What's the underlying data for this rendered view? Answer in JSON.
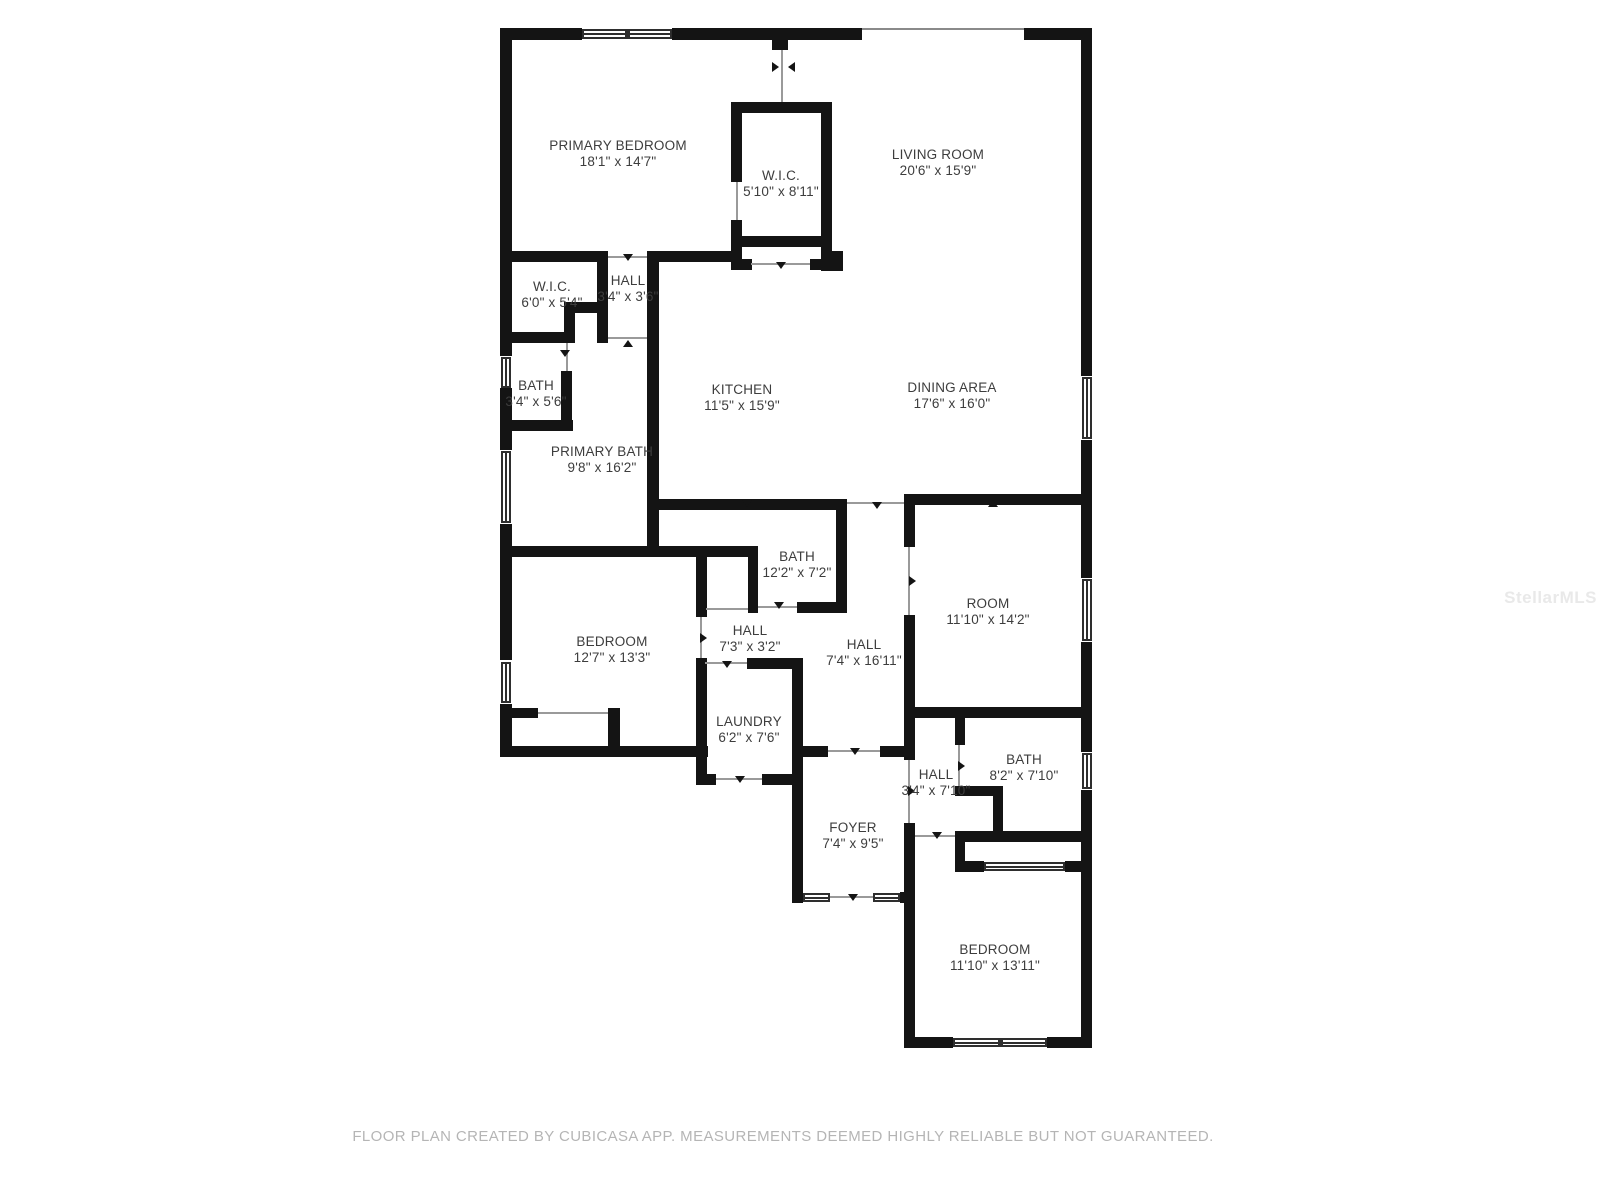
{
  "footer": "FLOOR PLAN CREATED BY CUBICASA APP. MEASUREMENTS DEEMED HIGHLY RELIABLE BUT NOT GUARANTEED.",
  "watermark": "StellarMLS",
  "colors": {
    "wall": "#141414",
    "label": "#3d3d3d",
    "footer": "#b5b5b5",
    "watermark": "#e9e9e9"
  },
  "rooms": [
    {
      "id": "primary-bedroom",
      "name": "PRIMARY BEDROOM",
      "dims": "18'1\" x 14'7\""
    },
    {
      "id": "wic-primary",
      "name": "W.I.C.",
      "dims": "5'10\" x 8'11\""
    },
    {
      "id": "living-room",
      "name": "LIVING ROOM",
      "dims": "20'6\" x 15'9\""
    },
    {
      "id": "wic-small",
      "name": "W.I.C.",
      "dims": "6'0\" x 5'4\""
    },
    {
      "id": "hall-small",
      "name": "HALL",
      "dims": "3'4\" x 3'6\""
    },
    {
      "id": "bath-small",
      "name": "BATH",
      "dims": "3'4\" x 5'6\""
    },
    {
      "id": "kitchen",
      "name": "KITCHEN",
      "dims": "11'5\" x 15'9\""
    },
    {
      "id": "dining-area",
      "name": "DINING AREA",
      "dims": "17'6\" x 16'0\""
    },
    {
      "id": "primary-bath",
      "name": "PRIMARY BATH",
      "dims": "9'8\" x 16'2\""
    },
    {
      "id": "bath-middle",
      "name": "BATH",
      "dims": "12'2\" x 7'2\""
    },
    {
      "id": "room",
      "name": "ROOM",
      "dims": "11'10\" x 14'2\""
    },
    {
      "id": "bedroom-left",
      "name": "BEDROOM",
      "dims": "12'7\" x 13'3\""
    },
    {
      "id": "hall-center",
      "name": "HALL",
      "dims": "7'3\" x 3'2\""
    },
    {
      "id": "hall-long",
      "name": "HALL",
      "dims": "7'4\" x 16'11\""
    },
    {
      "id": "laundry",
      "name": "LAUNDRY",
      "dims": "6'2\" x 7'6\""
    },
    {
      "id": "hall-east",
      "name": "HALL",
      "dims": "3'4\" x 7'10\""
    },
    {
      "id": "bath-east",
      "name": "BATH",
      "dims": "8'2\" x 7'10\""
    },
    {
      "id": "foyer",
      "name": "FOYER",
      "dims": "7'4\" x 9'5\""
    },
    {
      "id": "bedroom-bottom",
      "name": "BEDROOM",
      "dims": "11'10\" x 13'11\""
    }
  ]
}
